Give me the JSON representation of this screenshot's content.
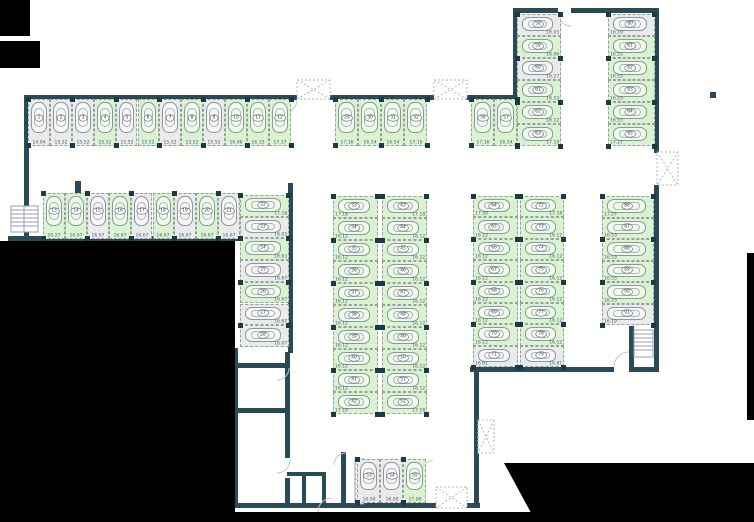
{
  "canvas": {
    "width": 754,
    "height": 522
  },
  "colors": {
    "space_free": "#d9f3d0",
    "space_taken": "#e9eaea",
    "wall": "#2a4a58",
    "pillar": "#1c3945",
    "measure_text": "#4e616c",
    "outside_mask": "#000000"
  },
  "icons": {
    "shaft": "x-box-icon",
    "stairs": "stairs-icon",
    "door": "door-arc-icon",
    "car": "car-icon"
  },
  "plan": {
    "groups": [
      {
        "id": "row-1-12",
        "orient": "v",
        "x": 28,
        "y": 99,
        "step": 21.9,
        "w": 21.9,
        "h": 47,
        "measAlign": "center",
        "spaces": [
          {
            "n": "1",
            "s": "taken",
            "m": "14.04"
          },
          {
            "n": "2",
            "s": "taken",
            "m": "15.52"
          },
          {
            "n": "3",
            "s": "taken",
            "m": "15.52"
          },
          {
            "n": "4",
            "s": "free",
            "m": "15.52"
          },
          {
            "n": "5",
            "s": "taken",
            "m": "15.52"
          },
          {
            "n": "6",
            "s": "free",
            "m": "15.52"
          },
          {
            "n": "7",
            "s": "taken",
            "m": "15.52"
          },
          {
            "n": "8",
            "s": "free",
            "m": "15.52"
          },
          {
            "n": "9",
            "s": "taken",
            "m": "15.52"
          },
          {
            "n": "10",
            "s": "free",
            "m": "16.06"
          },
          {
            "n": "11",
            "s": "free",
            "m": "16.33"
          },
          {
            "n": "12",
            "s": "free",
            "m": "17.37"
          }
        ]
      },
      {
        "id": "row-29-32",
        "orient": "v",
        "x": 335,
        "y": 99,
        "step": 23,
        "w": 23,
        "h": 47,
        "measAlign": "center",
        "spaces": [
          {
            "n": "29",
            "s": "free",
            "m": "17.16"
          },
          {
            "n": "30",
            "s": "free",
            "m": "16.54"
          },
          {
            "n": "31",
            "s": "free",
            "m": "16.54"
          },
          {
            "n": "32",
            "s": "free",
            "m": "17.16"
          }
        ]
      },
      {
        "id": "row-56-57",
        "orient": "v",
        "x": 471,
        "y": 99,
        "step": 23,
        "w": 23,
        "h": 47,
        "measAlign": "center",
        "spaces": [
          {
            "n": "56",
            "s": "free",
            "m": "17.16"
          },
          {
            "n": "57",
            "s": "free",
            "m": "16.54"
          }
        ]
      },
      {
        "id": "row-13-21",
        "orient": "v",
        "x": 43,
        "y": 193,
        "step": 21.9,
        "w": 21.9,
        "h": 46,
        "measAlign": "center",
        "spaces": [
          {
            "n": "13",
            "s": "free",
            "m": "20.27"
          },
          {
            "n": "14",
            "s": "free",
            "m": "16.67"
          },
          {
            "n": "15",
            "s": "taken",
            "m": "16.67"
          },
          {
            "n": "16",
            "s": "free",
            "m": "16.67"
          },
          {
            "n": "17",
            "s": "taken",
            "m": "16.67"
          },
          {
            "n": "18",
            "s": "free",
            "m": "16.67"
          },
          {
            "n": "19",
            "s": "taken",
            "m": "16.67"
          },
          {
            "n": "20",
            "s": "free",
            "m": "16.67"
          },
          {
            "n": "21",
            "s": "taken",
            "m": "16.67"
          }
        ]
      },
      {
        "id": "col-22-28",
        "orient": "h",
        "x": 240,
        "y": 195,
        "step": 21.7,
        "w": 49,
        "measAlign": "right",
        "spaces": [
          {
            "n": "22",
            "s": "free",
            "m": "17.18"
          },
          {
            "n": "23",
            "s": "taken",
            "m": "16.03"
          },
          {
            "n": "24",
            "s": "free",
            "m": "16.63"
          },
          {
            "n": "25",
            "s": "taken",
            "m": "16.67"
          },
          {
            "n": "26",
            "s": "free",
            "m": "16.67"
          },
          {
            "n": "27",
            "s": "taken",
            "m": "16.67"
          },
          {
            "n": "28",
            "s": "taken",
            "m": "16.07"
          }
        ]
      },
      {
        "id": "col-33-42",
        "orient": "h",
        "x": 333,
        "y": 196,
        "step": 21.8,
        "w": 45,
        "measAlign": "left",
        "spaces": [
          {
            "n": "33",
            "s": "free",
            "m": "17.18"
          },
          {
            "n": "34",
            "s": "free",
            "m": "16.12"
          },
          {
            "n": "35",
            "s": "free",
            "m": "16.12"
          },
          {
            "n": "36",
            "s": "free",
            "m": "16.12"
          },
          {
            "n": "37",
            "s": "free",
            "m": "16.12"
          },
          {
            "n": "38",
            "s": "free",
            "m": "16.12"
          },
          {
            "n": "39",
            "s": "free",
            "m": "16.12"
          },
          {
            "n": "40",
            "s": "free",
            "m": "16.12"
          },
          {
            "n": "41",
            "s": "free",
            "m": "16.12"
          },
          {
            "n": "42",
            "s": "free",
            "m": "17.18"
          }
        ]
      },
      {
        "id": "col-43-52",
        "orient": "h",
        "x": 382,
        "y": 196,
        "step": 21.8,
        "w": 45,
        "measAlign": "right",
        "spaces": [
          {
            "n": "43",
            "s": "free",
            "m": "17.18"
          },
          {
            "n": "44",
            "s": "free",
            "m": "16.12"
          },
          {
            "n": "45",
            "s": "free",
            "m": "16.12"
          },
          {
            "n": "46",
            "s": "free",
            "m": "16.12"
          },
          {
            "n": "47",
            "s": "free",
            "m": "16.12"
          },
          {
            "n": "48",
            "s": "free",
            "m": "16.12"
          },
          {
            "n": "49",
            "s": "free",
            "m": "16.12"
          },
          {
            "n": "50",
            "s": "free",
            "m": "16.12"
          },
          {
            "n": "51",
            "s": "free",
            "m": "16.12"
          },
          {
            "n": "52",
            "s": "free",
            "m": "17.18"
          }
        ]
      },
      {
        "id": "col-64-71",
        "orient": "h",
        "x": 473,
        "y": 196,
        "step": 21.4,
        "w": 45,
        "measAlign": "left",
        "spaces": [
          {
            "n": "64",
            "s": "free",
            "m": "17.30"
          },
          {
            "n": "65",
            "s": "free",
            "m": "16.12"
          },
          {
            "n": "66",
            "s": "free",
            "m": "16.12"
          },
          {
            "n": "67",
            "s": "free",
            "m": "16.12"
          },
          {
            "n": "68",
            "s": "free",
            "m": "16.12"
          },
          {
            "n": "69",
            "s": "free",
            "m": "16.12"
          },
          {
            "n": "70",
            "s": "free",
            "m": "16.12"
          },
          {
            "n": "71",
            "s": "taken",
            "m": "16.81"
          }
        ]
      },
      {
        "id": "col-72-79",
        "orient": "h",
        "x": 520,
        "y": 196,
        "step": 21.4,
        "w": 44,
        "measAlign": "right",
        "spaces": [
          {
            "n": "72",
            "s": "free",
            "m": "17.18"
          },
          {
            "n": "73",
            "s": "free",
            "m": "16.12"
          },
          {
            "n": "74",
            "s": "free",
            "m": "16.12"
          },
          {
            "n": "75",
            "s": "free",
            "m": "16.12"
          },
          {
            "n": "76",
            "s": "free",
            "m": "16.12"
          },
          {
            "n": "77",
            "s": "free",
            "m": "16.12"
          },
          {
            "n": "78",
            "s": "free",
            "m": "16.12"
          },
          {
            "n": "79",
            "s": "taken",
            "m": "16.81"
          }
        ]
      },
      {
        "id": "col-86-91",
        "orient": "h",
        "x": 602,
        "y": 196,
        "step": 21.5,
        "w": 52,
        "measAlign": "left",
        "spaces": [
          {
            "n": "86",
            "s": "free",
            "m": "17.27"
          },
          {
            "n": "87",
            "s": "free",
            "m": "16.53"
          },
          {
            "n": "88",
            "s": "free",
            "m": "16.53"
          },
          {
            "n": "89",
            "s": "free",
            "m": "16.53"
          },
          {
            "n": "90",
            "s": "free",
            "m": "16.53"
          },
          {
            "n": "91",
            "s": "taken",
            "m": "16.19"
          }
        ]
      },
      {
        "id": "col-58-63",
        "orient": "h",
        "x": 517,
        "y": 14,
        "step": 22,
        "w": 44,
        "measAlign": "right",
        "spaces": [
          {
            "n": "58",
            "s": "taken",
            "m": "16.05"
          },
          {
            "n": "59",
            "s": "free",
            "m": "16.06"
          },
          {
            "n": "60",
            "s": "taken",
            "m": "16.27"
          },
          {
            "n": "61",
            "s": "free",
            "m": "16.53"
          },
          {
            "n": "62",
            "s": "free",
            "m": "16.12"
          },
          {
            "n": "63",
            "s": "free",
            "m": "17.19"
          }
        ]
      },
      {
        "id": "col-80-85",
        "orient": "h",
        "x": 608,
        "y": 14,
        "step": 22,
        "w": 47,
        "measAlign": "left",
        "spaces": [
          {
            "n": "80",
            "s": "taken",
            "m": "16.19"
          },
          {
            "n": "81",
            "s": "free",
            "m": "16.53"
          },
          {
            "n": "82",
            "s": "free",
            "m": "16.53"
          },
          {
            "n": "83",
            "s": "free",
            "m": "16.53"
          },
          {
            "n": "84",
            "s": "free",
            "m": "16.53"
          },
          {
            "n": "85",
            "s": "free",
            "m": "17.27"
          }
        ]
      },
      {
        "id": "row-53-55",
        "orient": "v",
        "x": 357,
        "y": 459,
        "step": 23,
        "w": 23,
        "h": 44,
        "measAlign": "center",
        "spaces": [
          {
            "n": "53",
            "s": "taken",
            "m": "16.00"
          },
          {
            "n": "54",
            "s": "taken",
            "m": "16.00"
          },
          {
            "n": "55",
            "s": "free",
            "m": "17.00"
          }
        ]
      }
    ]
  }
}
